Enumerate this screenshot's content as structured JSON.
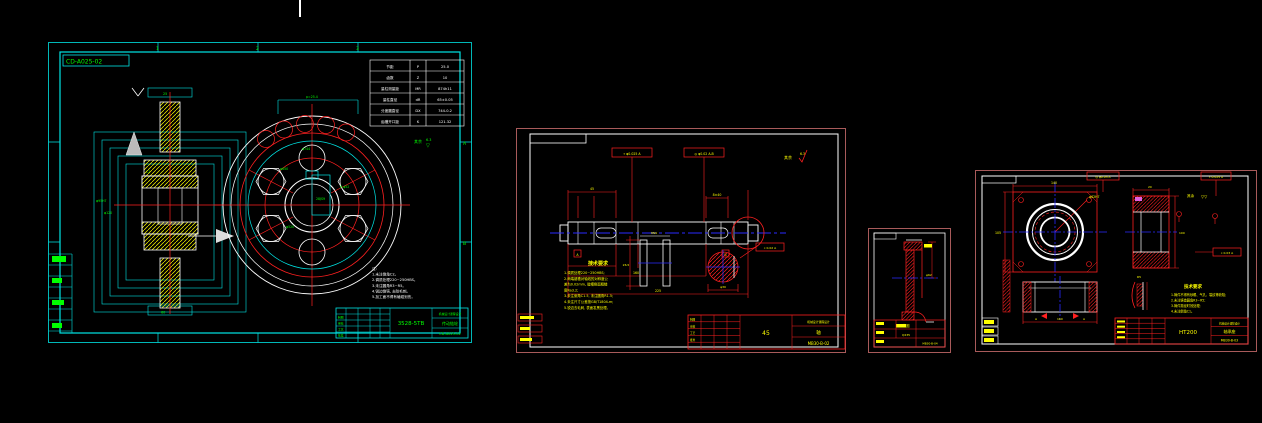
{
  "colors": {
    "cyan": "#00e5e5",
    "green": "#00ff00",
    "red": "#ff2020",
    "yellow": "#ffff00",
    "blue": "#2a2aff",
    "white": "#ffffff",
    "frame": "#a85a5a",
    "bg": "#000000"
  },
  "sheet1": {
    "corner_label": "CD-A025-02",
    "zones": {
      "top": [
        "1",
        "2",
        "3"
      ],
      "right": [
        "A",
        "B"
      ]
    },
    "table": {
      "rows": [
        [
          "节距",
          "P",
          "25.0"
        ],
        [
          "齿数",
          "Z",
          "10"
        ],
        [
          "量柱测量距",
          "MR",
          "874h11"
        ],
        [
          "量柱直径",
          "dR",
          "65±0.05"
        ],
        [
          "分度圆直径",
          "DX",
          "744-0.2"
        ],
        [
          "齿槽开口距",
          "K",
          "121.32"
        ]
      ]
    },
    "notes": [
      "注:",
      "1.未注倒角C2。",
      "2.调质处理220~250HBS。",
      "3.未注圆角R3~R5。",
      "4.锐边倒钝, 去除毛刺。",
      "5.加工面不得有磕碰划伤。"
    ],
    "title": {
      "model": "3528-5TB",
      "company": "机械设计课程设计",
      "part_name": "传动链轮",
      "drawing_no": "CD-A025-02",
      "cells": [
        "制图",
        "审核",
        "工艺",
        "批准"
      ]
    },
    "dims": {
      "d_outer": "φ744",
      "d_pitch": "φ650",
      "d_holes": "6-φ52",
      "d_bolt": "φ520",
      "key": "28JS9",
      "d_bore": "φ95H7",
      "d_hub": "φ120",
      "b_width": "25",
      "b_hub": "60",
      "tooth": "p=25.4",
      "chamfer": "C2",
      "rough_rest": "其余",
      "rough_val": "6.3",
      "tri": "▽"
    }
  },
  "sheet2": {
    "rough_rest": "其余",
    "rough_val": "6.3",
    "tol1": "⌖ φ0.025 A",
    "tol2": "◎ φ0.02 A-B",
    "tol3": "⌖ 0.02 A",
    "datum_a": "A",
    "datum_b": "B",
    "dims": {
      "seg1": "45",
      "seg2": "160",
      "total": "225",
      "keylen": "8×40",
      "key_w": "8N9",
      "key_d": "26.5",
      "sec_d": "φ30"
    },
    "notes_title": "技术要求",
    "notes": [
      "1.调质处理220~250HBS;",
      "2.两端键槽对轴线的对称度公",
      "  差为0.02mm, 键槽侧面粗糙",
      "  度Ra3.2;",
      "3.未注倒角C1.5, 未注圆角R1.5;",
      "4.未注尺寸公差按GB/T1804-m;",
      "5.锐边去毛刺, 表面发黑处理。"
    ],
    "title": {
      "material": "45",
      "company": "机械设计课程设计",
      "part_name": "轴",
      "drawing_no": "MB30-B-02",
      "cells": [
        "制图",
        "审核",
        "工艺",
        "批准"
      ]
    }
  },
  "sheet3": {
    "dims": {
      "d": "φ62"
    },
    "title": {
      "part_name": "挡圈",
      "material": "Q235",
      "drawing_no": "MB30-B-04"
    }
  },
  "sheet4": {
    "tol1": "◎ φ0.03 A",
    "tol2": "⌖ 0.025 A",
    "tol3": "⌖ 0.03 A",
    "rough_rest": "其余",
    "tri": "▽▽",
    "dims": {
      "w": "140",
      "h": "105",
      "bore": "φ62H7",
      "side_h": "100",
      "depth": "20",
      "base": "160",
      "sec": "A",
      "det": "R5"
    },
    "notes_title": "技术要求",
    "notes": [
      "1.铸件不得有砂眼、气孔、裂纹等缺陷;",
      "2.未注铸造圆角R3~R5;",
      "3.铸件需经时效处理;",
      "4.未注倒角C1。"
    ],
    "title": {
      "material": "HT200",
      "company": "机械设计课程设计",
      "part_name": "轴承座",
      "drawing_no": "MB30-B-03"
    }
  }
}
